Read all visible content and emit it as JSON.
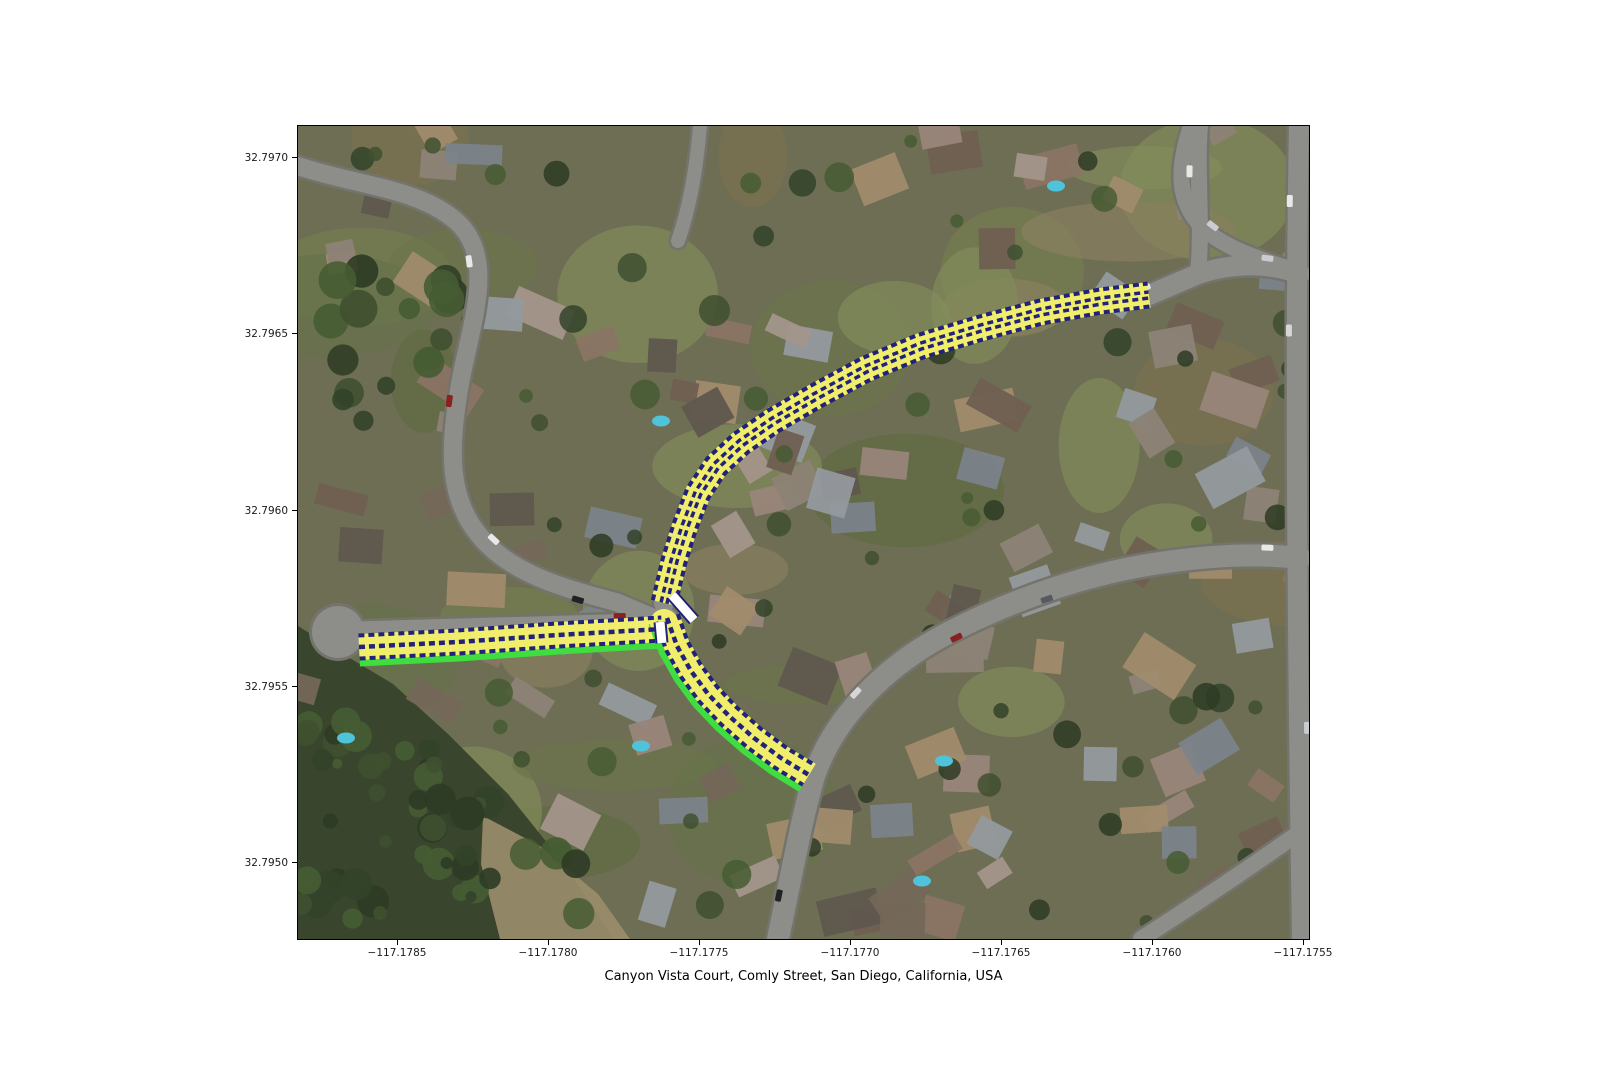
{
  "figure": {
    "title": "Canyon Vista Court, Comly Street, San Diego, California, USA"
  },
  "axes": {
    "x_ticks": [
      {
        "label": "−117.1785",
        "px": 100
      },
      {
        "label": "−117.1780",
        "px": 251
      },
      {
        "label": "−117.1775",
        "px": 402
      },
      {
        "label": "−117.1770",
        "px": 553
      },
      {
        "label": "−117.1765",
        "px": 704
      },
      {
        "label": "−117.1760",
        "px": 855
      },
      {
        "label": "−117.1755",
        "px": 1006
      }
    ],
    "y_ticks": [
      {
        "label": "32.7970",
        "px": 32
      },
      {
        "label": "32.7965",
        "px": 208
      },
      {
        "label": "32.7960",
        "px": 385
      },
      {
        "label": "32.7955",
        "px": 561
      },
      {
        "label": "32.7950",
        "px": 737
      }
    ]
  },
  "map": {
    "highlighted_streets": [
      "Canyon Vista Court",
      "Comly Street"
    ],
    "colors": {
      "lane_fill": "#f0ee6a",
      "lane_edge": "#22227a",
      "green_casing": "#3fdd3f",
      "crosswalk": "#ffffff",
      "road": "#8d8d89",
      "road_casing": "#74746c",
      "base": "#6e6e55"
    },
    "route_branches": [
      {
        "name": "canyon-vista-court-west",
        "center_line": "single",
        "green_offset": 16,
        "points": [
          [
            61,
            521
          ],
          [
            160,
            516
          ],
          [
            260,
            509
          ],
          [
            364,
            503
          ]
        ]
      },
      {
        "name": "comly-street",
        "center_line": "double",
        "green_offset": 0,
        "points": [
          [
            366,
            477
          ],
          [
            376,
            435
          ],
          [
            387,
            400
          ],
          [
            400,
            367
          ],
          [
            418,
            340
          ],
          [
            443,
            317
          ],
          [
            475,
            295
          ],
          [
            518,
            270
          ],
          [
            568,
            243
          ],
          [
            623,
            220
          ],
          [
            683,
            202
          ],
          [
            743,
            186
          ],
          [
            803,
            175
          ],
          [
            851,
            169
          ]
        ]
      },
      {
        "name": "canyon-vista-court-south",
        "center_line": "single",
        "green_offset": 16,
        "points": [
          [
            369,
            492
          ],
          [
            379,
            520
          ],
          [
            393,
            545
          ],
          [
            410,
            568
          ],
          [
            431,
            590
          ],
          [
            456,
            612
          ],
          [
            483,
            632
          ],
          [
            511,
            649
          ]
        ]
      }
    ],
    "junction": {
      "cx": 366,
      "cy": 497,
      "r": 14
    },
    "crosswalks": [
      {
        "from": [
          362,
          496
        ],
        "to": [
          364,
          517
        ]
      },
      {
        "from": [
          374,
          469
        ],
        "to": [
          396,
          494
        ]
      }
    ]
  }
}
